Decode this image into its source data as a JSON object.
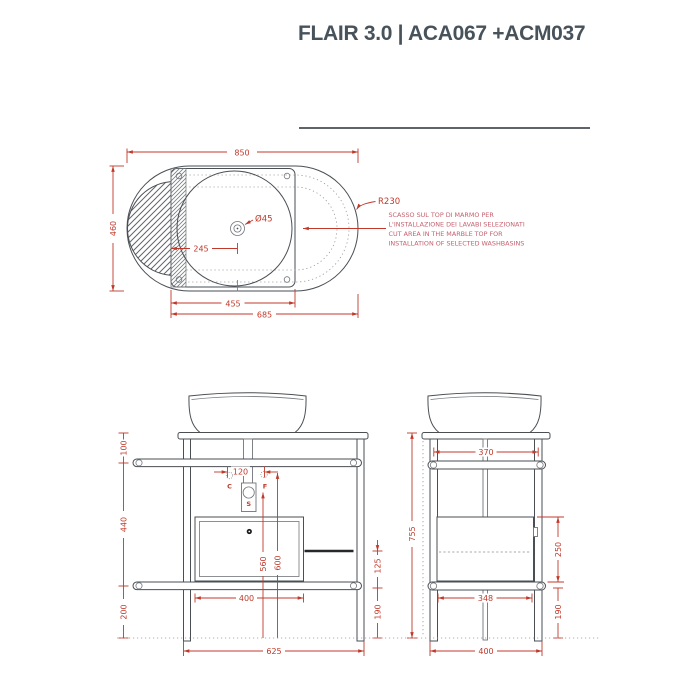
{
  "title": "FLAIR 3.0 | ACA067 +ACM037",
  "colors": {
    "dimension": "#c0392b",
    "note": "#c4606e",
    "line": "#4a4f54",
    "title": "#47525b"
  },
  "top_view": {
    "dim_width": "850",
    "dim_depth": "460",
    "dim_radius": "R230",
    "dim_drain": "Ø45",
    "dim_drain_offset": "245",
    "dim_cutout_width": "455",
    "dim_top_extent": "685",
    "note_lines": [
      "SCASSO SUL TOP DI MARMO PER",
      "L'INSTALLAZIONE DEI LAVABI SELEZIONATI",
      "CUT AREA IN THE MARBLE TOP FOR",
      "INSTALLATION OF SELECTED WASHBASINS"
    ]
  },
  "front_view": {
    "dim_top_to_rail": "100",
    "dim_rail_span": "440",
    "dim_rail_to_floor": "200",
    "dim_supply_spacing": "120",
    "dim_drain_height": "560",
    "dim_supply_height": "600",
    "dim_drawer_width": "400",
    "dim_base_width": "625",
    "dim_bar_to_shelf": "125",
    "dim_shelf_to_floor": "190",
    "label_cold": "C",
    "label_hot": "F",
    "label_drain": "S"
  },
  "side_view": {
    "dim_top_span": "370",
    "dim_total_height": "755",
    "dim_drawer_height": "250",
    "dim_shelf_to_floor": "190",
    "dim_inner_span": "348",
    "dim_base_width": "400"
  }
}
